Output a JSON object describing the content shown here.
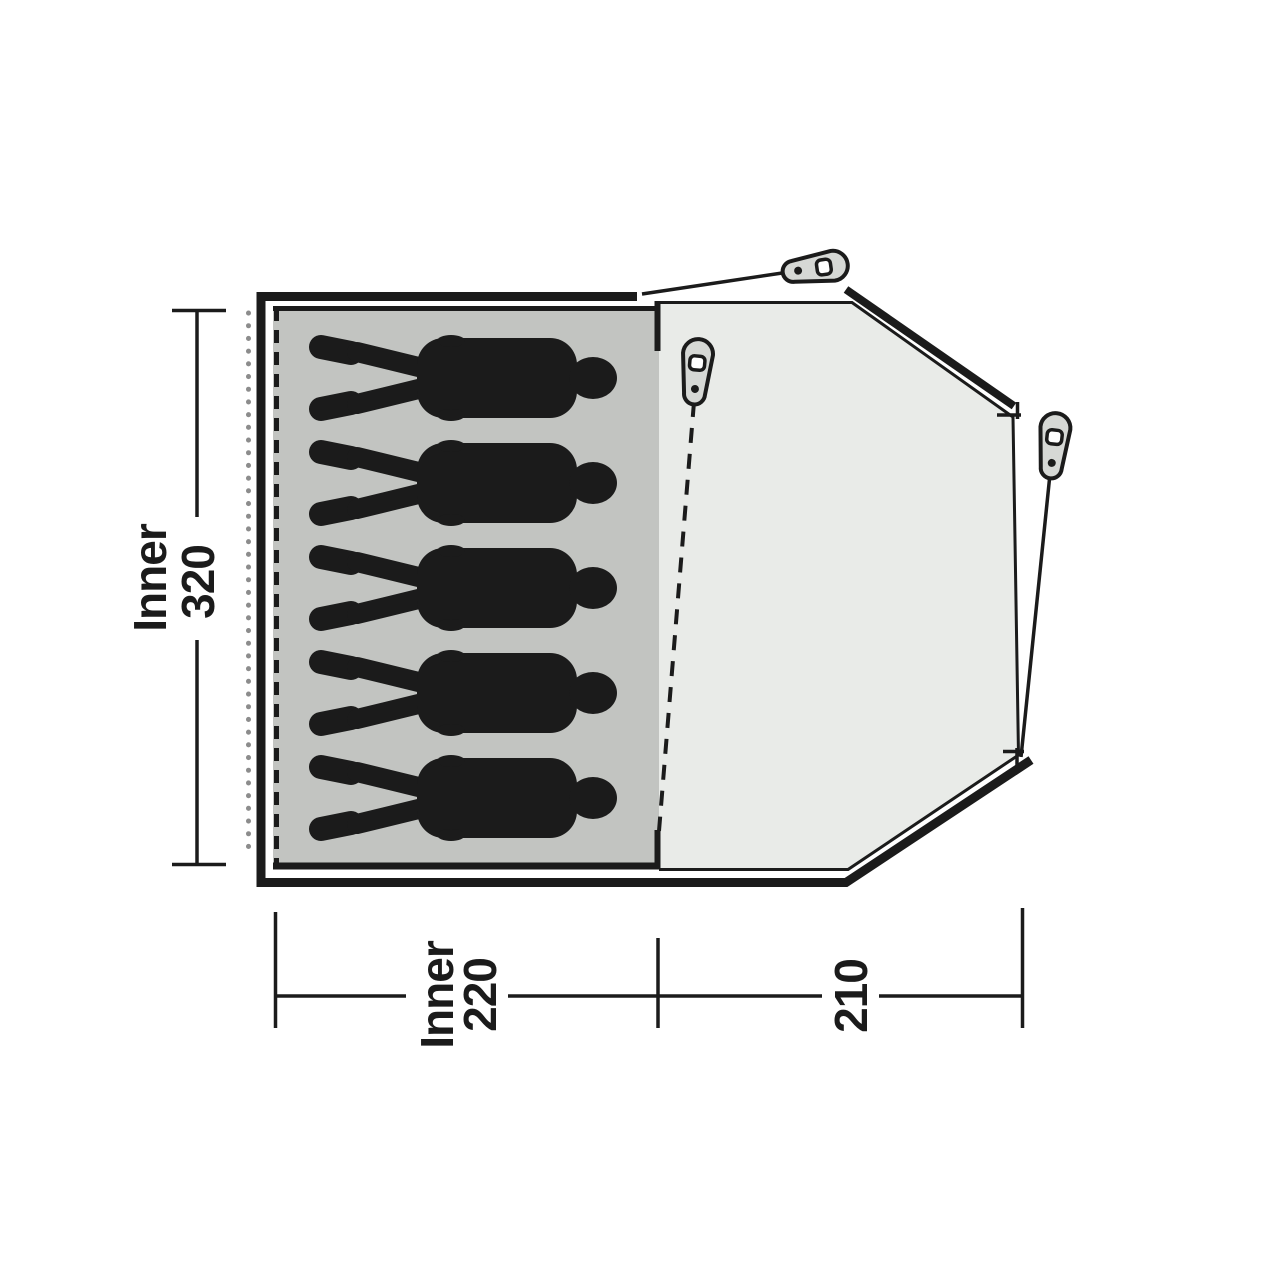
{
  "diagram_title": "tent-floorplan-top-view",
  "dimensions": {
    "inner_depth": {
      "label": "Inner",
      "value": "320"
    },
    "inner_width": {
      "label": "Inner",
      "value": "220"
    },
    "porch_width": {
      "value": "210"
    }
  },
  "sleeping": {
    "person_count": 5
  },
  "icons": {
    "tent-peg-icon": "teardrop-peg-with-hole-and-dot"
  },
  "colors": {
    "outline": "#1b1b1b",
    "inner-fill": "#c2c4c1",
    "porch-fill": "#e9ebe8",
    "silhouette": "#1b1b1b",
    "peg-fill": "#d6d8d5",
    "dot-line": "#8c8c8c",
    "label": "#1b1b1b"
  }
}
